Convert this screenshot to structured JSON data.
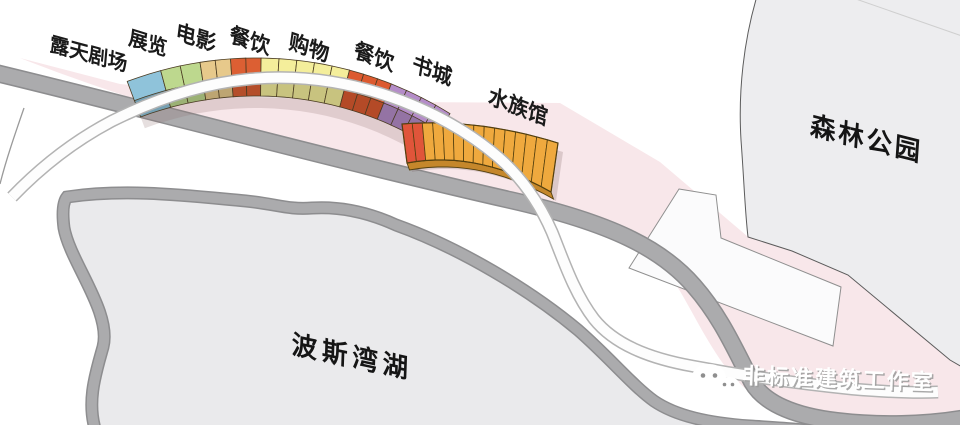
{
  "diagram_title": "曲线综合体功能分区示意图",
  "programs": [
    {
      "label": "露天剧场",
      "color": "#8fc3da",
      "divisions": 1,
      "span": 5.5
    },
    {
      "label": "展览",
      "color": "#bdd88e",
      "divisions": 2,
      "span": 6.3
    },
    {
      "label": "电影",
      "color": "#e7c98b",
      "divisions": 2,
      "span": 4.8
    },
    {
      "label": "餐饮",
      "color": "#dc5f33",
      "divisions": 2,
      "span": 4.8
    },
    {
      "label": "购物",
      "color": "#f4ee9b",
      "divisions": 5,
      "span": 14.0
    },
    {
      "label": "餐饮",
      "color": "#dc5a2f",
      "divisions": 3,
      "span": 6.9
    },
    {
      "label": "书城",
      "color": "#b48cc8",
      "divisions": 4,
      "span": 10.3
    }
  ],
  "aquarium": {
    "label": "水族馆",
    "color": "#efa93e",
    "accent_color": "#e0553a",
    "side_color": "#c5872b",
    "divisions": 15,
    "accent_divisions": 2
  },
  "zones": {
    "forest": {
      "label": "森林公园",
      "fill": "#ededef"
    },
    "lake": {
      "label": "波斯湾湖",
      "fill": "#eaeaec"
    }
  },
  "watermark": {
    "icon": "wechat-icon",
    "label": "非标准建筑工作室"
  },
  "colors": {
    "background": "#ffffff",
    "pink_zone": "#f8e7ea",
    "road": "#ababad",
    "road_edge": "#8d8d8f",
    "ribbon": "#fdfdfd",
    "ribbon_edge": "#b3b3b3",
    "outline": "#4a3b22"
  }
}
